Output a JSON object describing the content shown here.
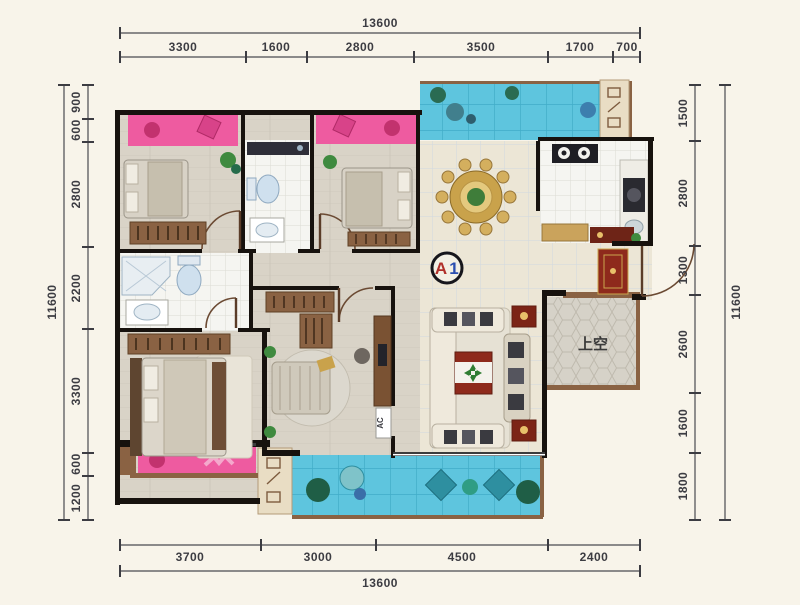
{
  "plan": {
    "type": "apartment-floor-plan",
    "unit_label": "A1",
    "unit_label_red": "A",
    "unit_label_blue": "1",
    "void_label": "上空",
    "ac_label": "AC",
    "dimensions": {
      "top": {
        "total": "13600",
        "segments": [
          "3300",
          "1600",
          "2800",
          "3500",
          "1700",
          "700"
        ]
      },
      "bottom": {
        "total": "13600",
        "segments": [
          "3700",
          "3000",
          "4500",
          "2400"
        ]
      },
      "left": {
        "total": "11600",
        "segments": [
          "900",
          "600",
          "2800",
          "2200",
          "3300",
          "600",
          "1200"
        ]
      },
      "right": {
        "total": "11600",
        "segments": [
          "1500",
          "2800",
          "1300",
          "2600",
          "1600",
          "1800"
        ]
      }
    },
    "colors": {
      "background": "#f8f4ea",
      "wall": "#17120e",
      "wood_trim": "#7d5b3e",
      "pink_bay": "#ee5ba0",
      "water_balcony": "#5ec5de",
      "floor_beige": "#ece6d6",
      "floor_plank": "#d9d3c7",
      "tile_white": "#f5f5f1",
      "void_gray": "#d6d2c8",
      "table_gold": "#c9a24b",
      "accent_red": "#8e2a1c",
      "plant_green": "#3f8a3f",
      "dim_text": "#3c3c42"
    },
    "icons": {
      "equipment_panel": "vent-louver-symbols",
      "door": "door-swing-arc",
      "ac": "air-conditioner-slot",
      "stove": "two-burner-stove",
      "dining": "round-dining-table"
    }
  }
}
